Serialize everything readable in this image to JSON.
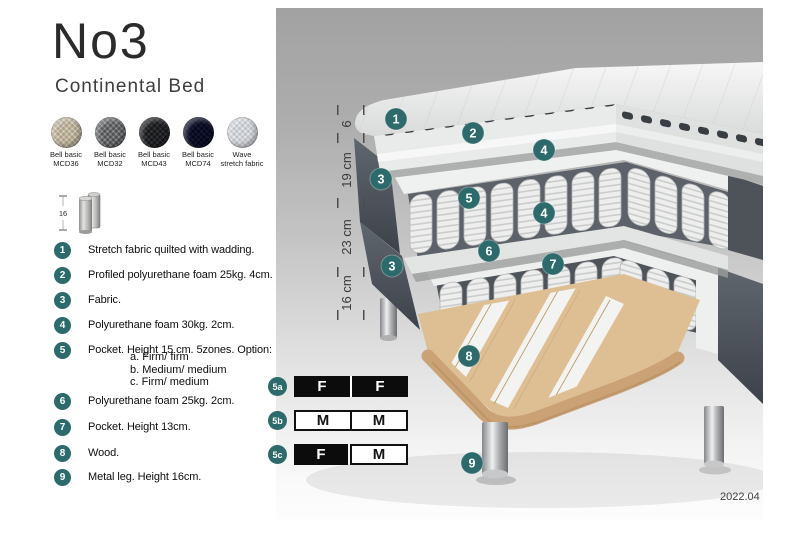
{
  "header": {
    "title": "No3",
    "subtitle": "Continental Bed"
  },
  "swatches": [
    {
      "line1": "Bell basic",
      "line2": "MCD36",
      "base": "#cfc9bb",
      "weave": "#efeade"
    },
    {
      "line1": "Bell basic",
      "line2": "MCD32",
      "base": "#8f9091",
      "weave": "#c5c6c7"
    },
    {
      "line1": "Bell basic",
      "line2": "MCD43",
      "base": "#4b4d50",
      "weave": "#797b7f"
    },
    {
      "line1": "Bell basic",
      "line2": "MCD74",
      "base": "#2b3150",
      "weave": "#4c557f"
    },
    {
      "line1": "Wave",
      "line2": "stretch fabric",
      "base": "#dcdee1",
      "weave": "#f5f6f8"
    }
  ],
  "leg_thumb": {
    "dimension": "16"
  },
  "legend": [
    {
      "num": "1",
      "text": "Stretch fabric quilted with wadding."
    },
    {
      "num": "2",
      "text": "Profiled polyurethane foam 25kg. 4cm."
    },
    {
      "num": "3",
      "text": "Fabric."
    },
    {
      "num": "4",
      "text": "Polyurethane foam 30kg. 2cm."
    },
    {
      "num": "5",
      "text": "Pocket. Height 15 cm. 5zones. Option:",
      "options": [
        "a. Firm/ firm",
        "b. Medium/ medium",
        "c. Firm/ medium"
      ]
    },
    {
      "num": "6",
      "text": "Polyurethane foam 25kg. 2cm."
    },
    {
      "num": "7",
      "text": "Pocket. Height 13cm."
    },
    {
      "num": "8",
      "text": "Wood."
    },
    {
      "num": "9",
      "text": "Metal leg. Height 16cm."
    }
  ],
  "diagram": {
    "dimensions": [
      "6",
      "19 cm",
      "23 cm",
      "16 cm"
    ],
    "callouts": {
      "c1": "1",
      "c2": "2",
      "c3": "3",
      "c4": "4",
      "c5": "5",
      "c6": "6",
      "c7": "7",
      "c8": "8",
      "c9": "9"
    },
    "version": "2022.04"
  },
  "firmness": {
    "rows": [
      {
        "label": "5a",
        "left": "F",
        "right": "F"
      },
      {
        "label": "5b",
        "left": "M",
        "right": "M"
      },
      {
        "label": "5c",
        "left": "F",
        "right": "M"
      }
    ]
  },
  "colors": {
    "accent": "#2d6a6b",
    "fabric_dark": "#4a4f57",
    "wood": "#dcbd92",
    "spring": "#ecedec"
  }
}
